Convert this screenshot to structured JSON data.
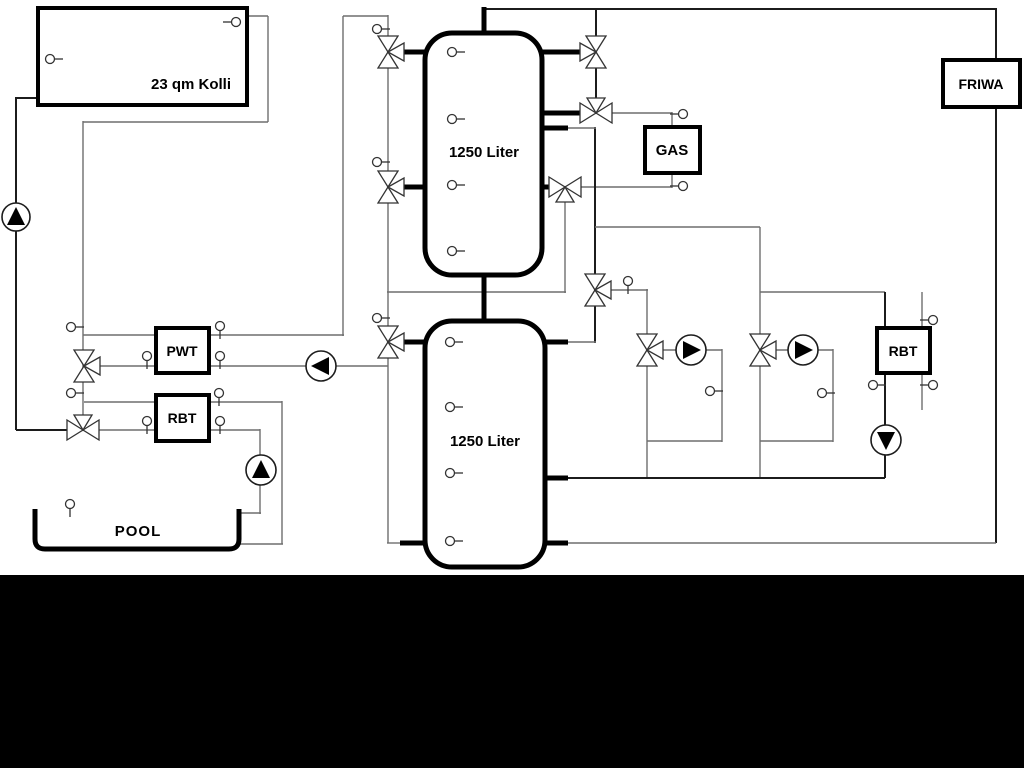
{
  "diagram": {
    "title_note": "hydraulic heating schematic",
    "solar_collector": {
      "label": "23 qm Kolli"
    },
    "buffer_tank_top": {
      "label": "1250 Liter"
    },
    "buffer_tank_bottom": {
      "label": "1250 Liter"
    },
    "gas_boiler": {
      "label": "GAS"
    },
    "friwa_station": {
      "label": "FRIWA"
    },
    "pwt_heat_exchanger": {
      "label": "PWT"
    },
    "pool_heat_exchanger": {
      "label": "RBT"
    },
    "secondary_heat_exchanger": {
      "label": "RBT"
    },
    "pool": {
      "label": "POOL"
    }
  },
  "colors": {
    "background": "#ffffff",
    "line_gray": "#6e6e6e",
    "line_dark": "#1c1c1c",
    "outline_black": "#000000",
    "symbol_stroke": "#333333",
    "bottom_bar": "#000000"
  }
}
